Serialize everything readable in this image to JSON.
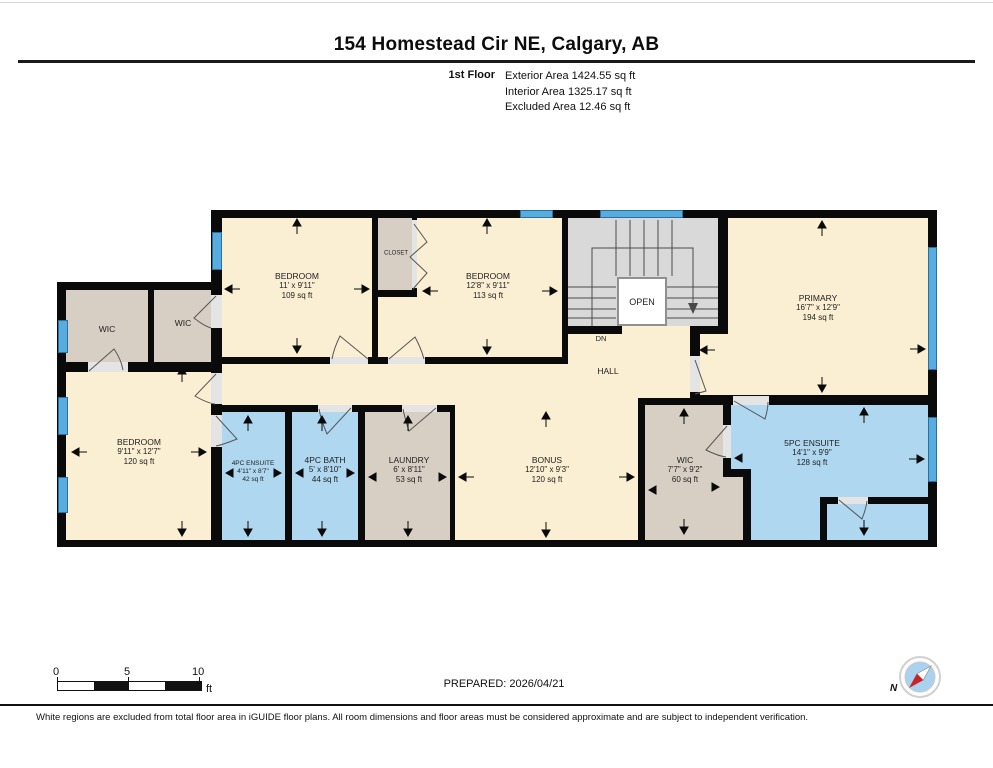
{
  "header": {
    "title": "154 Homestead Cir NE, Calgary, AB",
    "floor_label": "1st Floor",
    "stats": [
      "Exterior Area 1424.55 sq ft",
      "Interior Area 1325.17 sq ft",
      "Excluded Area 12.46 sq ft"
    ]
  },
  "plan": {
    "rooms": [
      {
        "name": "WIC"
      },
      {
        "name": "WIC"
      },
      {
        "name": "BEDROOM",
        "dims": "11' x 9'11\"",
        "area": "109 sq ft"
      },
      {
        "name": "CLOSET"
      },
      {
        "name": "BEDROOM",
        "dims": "12'8\" x 9'11\"",
        "area": "113 sq ft"
      },
      {
        "name": "PRIMARY",
        "dims": "16'7\" x 12'9\"",
        "area": "194 sq ft"
      },
      {
        "name": "BEDROOM",
        "dims": "9'11\" x 12'7\"",
        "area": "120 sq ft"
      },
      {
        "name": "4PC ENSUITE",
        "dims": "4'11\" x 8'7\"",
        "area": "42 sq ft"
      },
      {
        "name": "4PC BATH",
        "dims": "5' x 8'10\"",
        "area": "44 sq ft"
      },
      {
        "name": "LAUNDRY",
        "dims": "6' x 8'11\"",
        "area": "53 sq ft"
      },
      {
        "name": "BONUS",
        "dims": "12'10\" x 9'3\"",
        "area": "120 sq ft"
      },
      {
        "name": "WIC",
        "dims": "7'7\" x 9'2\"",
        "area": "60 sq ft"
      },
      {
        "name": "5PC ENSUITE",
        "dims": "14'1\" x 9'9\"",
        "area": "128 sq ft"
      }
    ],
    "labels": {
      "hall": "HALL",
      "dn": "DN",
      "open": "OPEN"
    }
  },
  "footer": {
    "scale_ticks": [
      "0",
      "5",
      "10"
    ],
    "scale_unit": "ft",
    "prepared": "PREPARED: 2026/04/21",
    "compass_n": "N",
    "disclaimer": "White regions are excluded from total floor area in iGUIDE floor plans. All room dimensions and floor areas must be considered approximate and are subject to independent verification."
  },
  "colors": {
    "room_cream": "#FAEFD2",
    "room_tan": "#D8CFC4",
    "room_wet_blue": "#AFD7F0",
    "stairs_gray": "#D9D9D9",
    "wall_black": "#0A0A0A",
    "window_blue": "#58ACDF",
    "compass_red": "#CC2128"
  }
}
